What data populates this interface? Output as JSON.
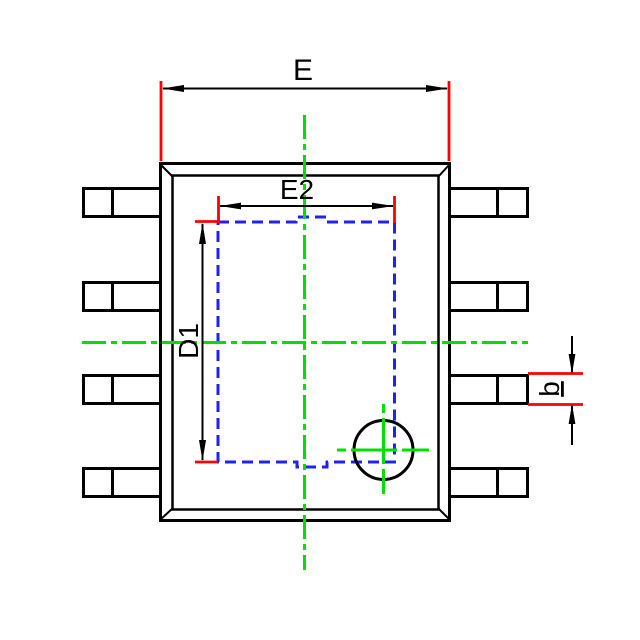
{
  "drawing": {
    "kind": "package-outline-diagram",
    "package": {
      "pin_count": 8,
      "pins_per_side": 4
    }
  },
  "labels": {
    "e": "E",
    "e2": "E2",
    "d1": "D1",
    "b": "b"
  },
  "colors": {
    "black": "#000000",
    "red": "#ff0000",
    "green": "#00e000",
    "blue": "#2222ee",
    "bg": "#ffffff"
  }
}
